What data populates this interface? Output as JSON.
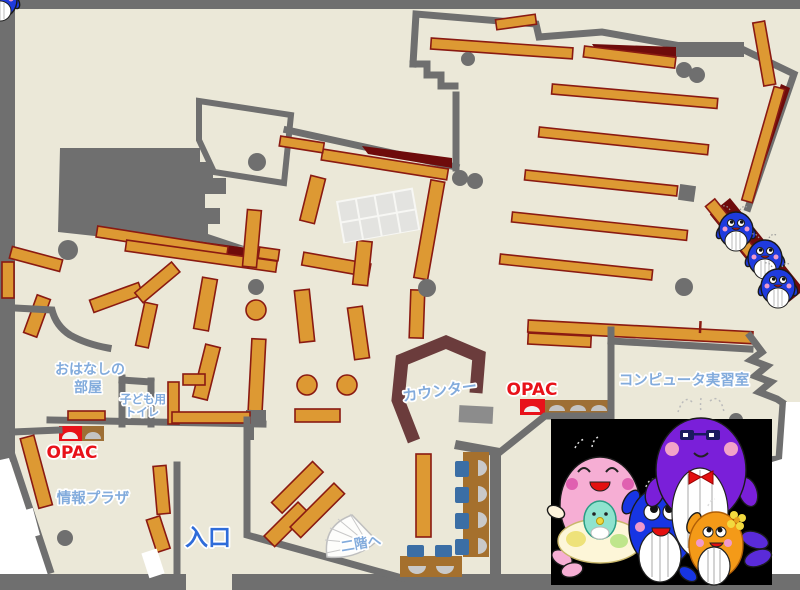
{
  "map": {
    "labels": {
      "storytelling_room": {
        "line1": "おはなしの",
        "line2": "部屋"
      },
      "kids_toilet": {
        "line1": "子ども用",
        "line2": "トイレ"
      },
      "opac_left": "OPAC",
      "opac_right": "OPAC",
      "info_plaza": "情報プラザ",
      "entrance": "入口",
      "counter": "カウンター",
      "computer_room": "コンピュータ実習室",
      "stairs_up": "二階へ"
    },
    "colors": {
      "floor": "#EBE8D8",
      "wall": "#6F6F6F",
      "shelf": "#DD9933",
      "shelf_border": "#8A1A12",
      "accent_dark_red": "#6E0B0B",
      "counter": "#6B3C3C",
      "label_blue": "#82ABDC",
      "entrance_blue": "#2F6CD9",
      "opac_red": "#E8121A",
      "chair_blue": "#3B6EA5",
      "desk_brown": "#A5702D",
      "photo_panel_bg": "#000000"
    },
    "mascots": {
      "small_blue_whales_count": 3,
      "group_members": [
        "pink-whale-with-baby",
        "blue-whale",
        "purple-whale",
        "orange-whale"
      ]
    }
  }
}
